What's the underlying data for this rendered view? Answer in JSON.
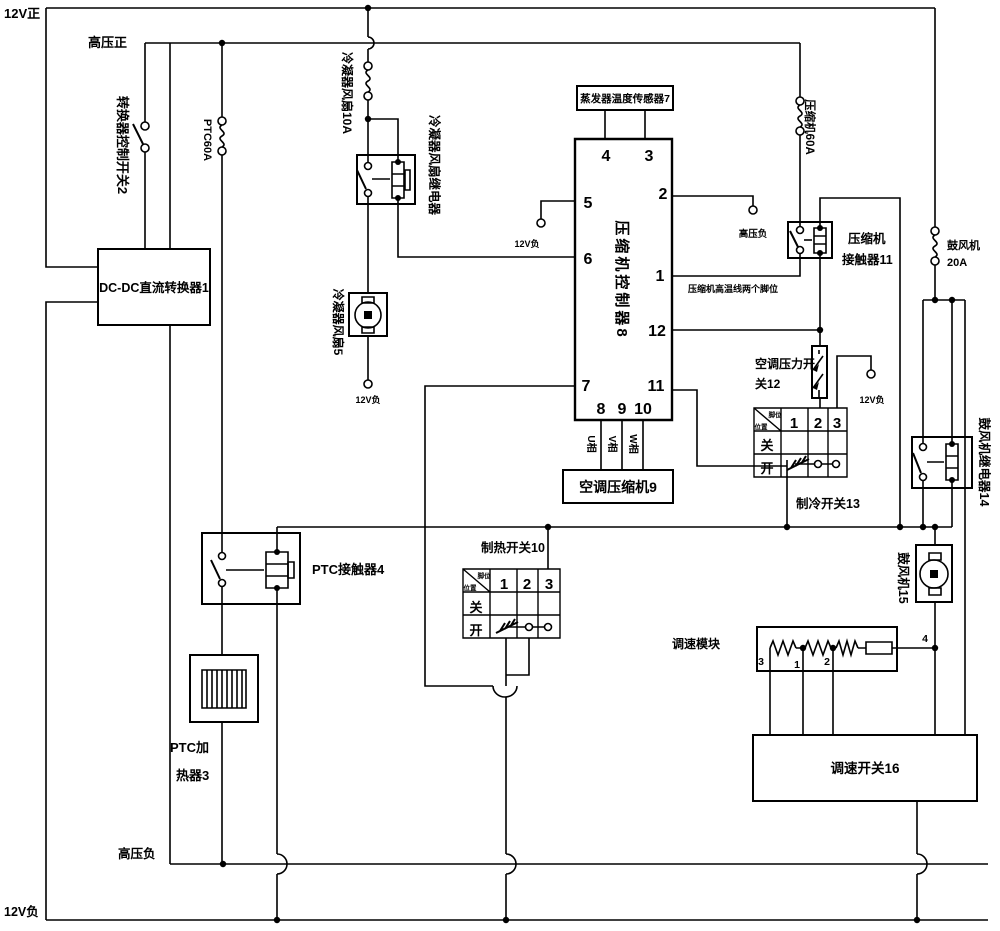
{
  "colors": {
    "line": "#000000",
    "background": "#ffffff"
  },
  "power": {
    "v12_pos": "12V正",
    "v12_neg": "12V负",
    "hv_pos": "高压正",
    "hv_neg": "高压负",
    "v12_neg_fan_terminal": "12V负",
    "v12_neg_pin5_terminal": "12V负",
    "hv_neg_pin2_terminal": "高压负",
    "v12_neg_pressure_terminal": "12V负"
  },
  "components": {
    "dcdc_converter": "DC-DC直流转换器1",
    "converter_switch": "转换器控制开关2",
    "ptc_heater_line1": "PTC加",
    "ptc_heater_line2": "热器3",
    "ptc_contactor": "PTC接触器4",
    "condenser_fan": "冷凝器风扇5",
    "condenser_fan_relay": "冷凝器风扇继电器",
    "evaporator_sensor": "蒸发器温度传感器7",
    "compressor_controller": "压缩机控制器8",
    "ac_compressor": "空调压缩机9",
    "compressor_contactor_line1": "压缩机",
    "compressor_contactor_line2": "接触器11",
    "pressure_switch_line1": "空调压力开",
    "pressure_switch_line2": "关12",
    "blower_relay": "鼓风机继电器14",
    "blower": "鼓风机15",
    "speed_module": "调速模块",
    "speed_switch": "调速开关16"
  },
  "fuses": {
    "ptc": "PTC60A",
    "condenser_fan": "冷凝器风扇10A",
    "compressor": "压缩机60A",
    "blower_line1": "鼓风机",
    "blower_line2": "20A"
  },
  "controller_pins": {
    "p1": "1",
    "p2": "2",
    "p3": "3",
    "p4": "4",
    "p5": "5",
    "p6": "6",
    "p7": "7",
    "p8": "8",
    "p9": "9",
    "p10": "10",
    "p11": "11",
    "p12": "12"
  },
  "phases": {
    "u": "U相",
    "v": "V相",
    "w": "W相"
  },
  "note": {
    "compressor_high_temp": "压缩机高温线两个脚位"
  },
  "tables": {
    "cooling": {
      "title": "制冷开关13",
      "corner_top": "脚位",
      "corner_bottom": "位置",
      "cols": [
        "1",
        "2",
        "3"
      ],
      "row_off": "关",
      "row_on": "开"
    },
    "heating": {
      "title": "制热开关10",
      "corner_top": "脚位",
      "corner_bottom": "位置",
      "cols": [
        "1",
        "2",
        "3"
      ],
      "row_off": "关",
      "row_on": "开"
    }
  },
  "speed_module_terminals": {
    "t1": "1",
    "t2": "2",
    "t3": "3",
    "t4": "4"
  }
}
